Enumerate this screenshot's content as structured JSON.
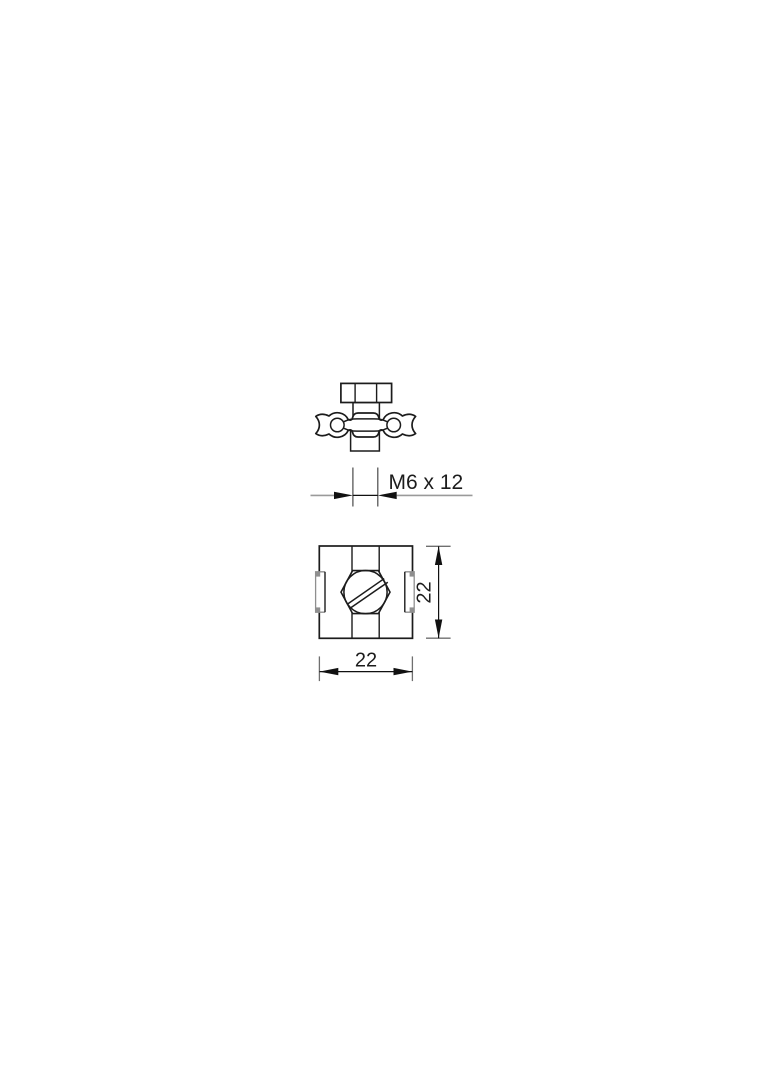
{
  "page": {
    "background": "#ffffff"
  },
  "drawing": {
    "type": "technical-dimension-drawing",
    "object_line_color": "#1c1c1c",
    "dimension_tail_color": "#9a9a9a",
    "extension_line_color": "#6f6f6f",
    "arrow_color": "#111111",
    "dimensions": {
      "thread": {
        "label": "M6 x 12"
      },
      "height": {
        "label": "22"
      },
      "width": {
        "label": "22"
      }
    }
  }
}
